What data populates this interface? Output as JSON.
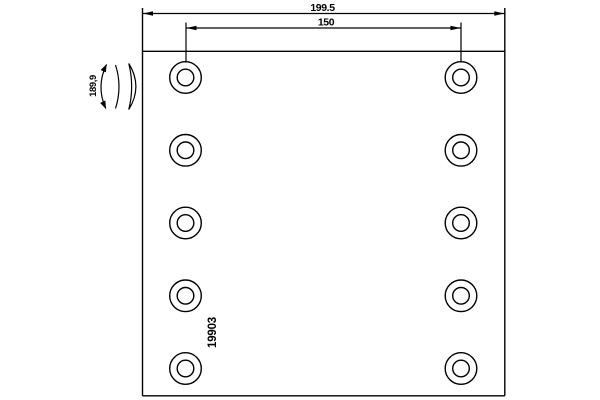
{
  "colors": {
    "background": "#ffffff",
    "line": "#000000",
    "text": "#000000"
  },
  "dimensions": {
    "overall_width": "199.5",
    "hole_pitch": "150",
    "curvature": "189,9"
  },
  "part_number": "19903",
  "holes": {
    "count": 10,
    "columns": 2,
    "rows": 5
  }
}
